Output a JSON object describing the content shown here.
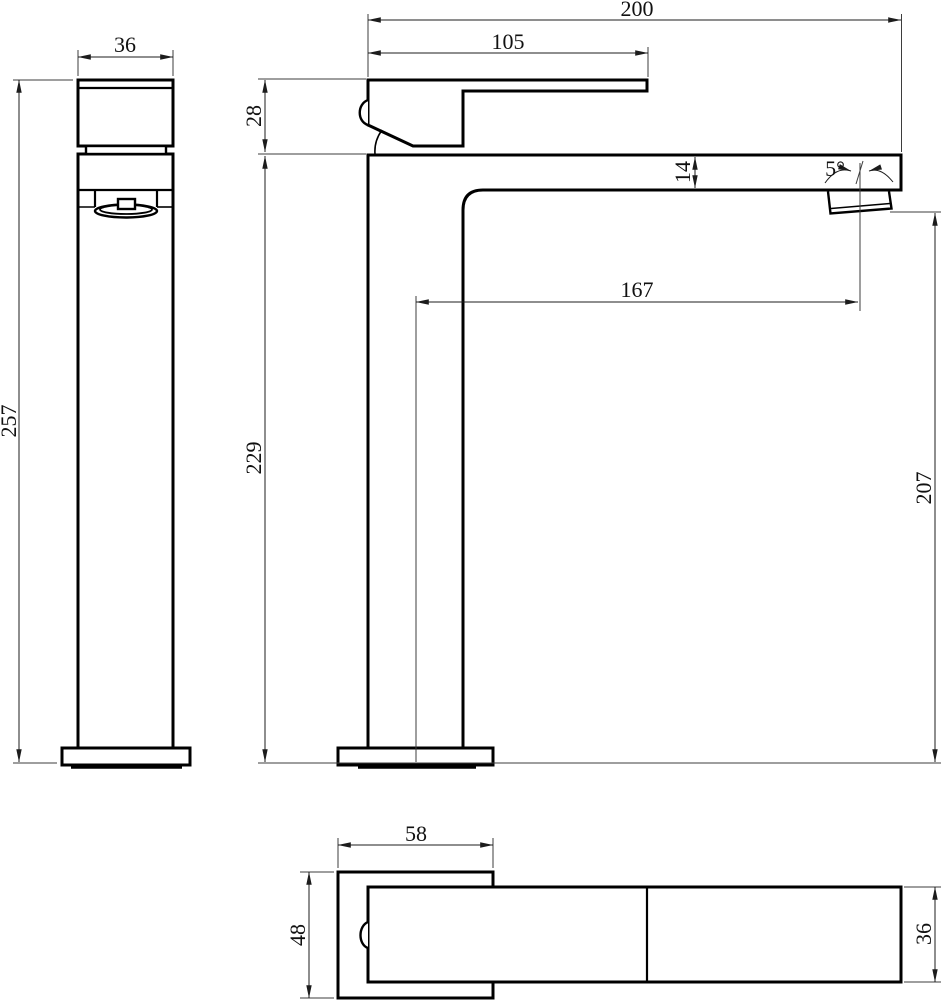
{
  "drawing": {
    "subject": "tall single-lever basin faucet",
    "views": {
      "side_view": "left side elevation",
      "front_view": "front elevation",
      "top_view": "plan view"
    },
    "line_color": "#000000",
    "background_color": "#ffffff"
  },
  "dimensions": {
    "side_width": "36",
    "side_height": "257",
    "front_total_length": "200",
    "front_handle_length": "105",
    "front_handle_height": "28",
    "front_spout_thickness": "14",
    "front_spout_angle": "5°",
    "front_spout_reach": "167",
    "front_body_height": "229",
    "front_outlet_height": "207",
    "top_base_width": "58",
    "top_base_depth": "48",
    "top_body_width": "36"
  }
}
